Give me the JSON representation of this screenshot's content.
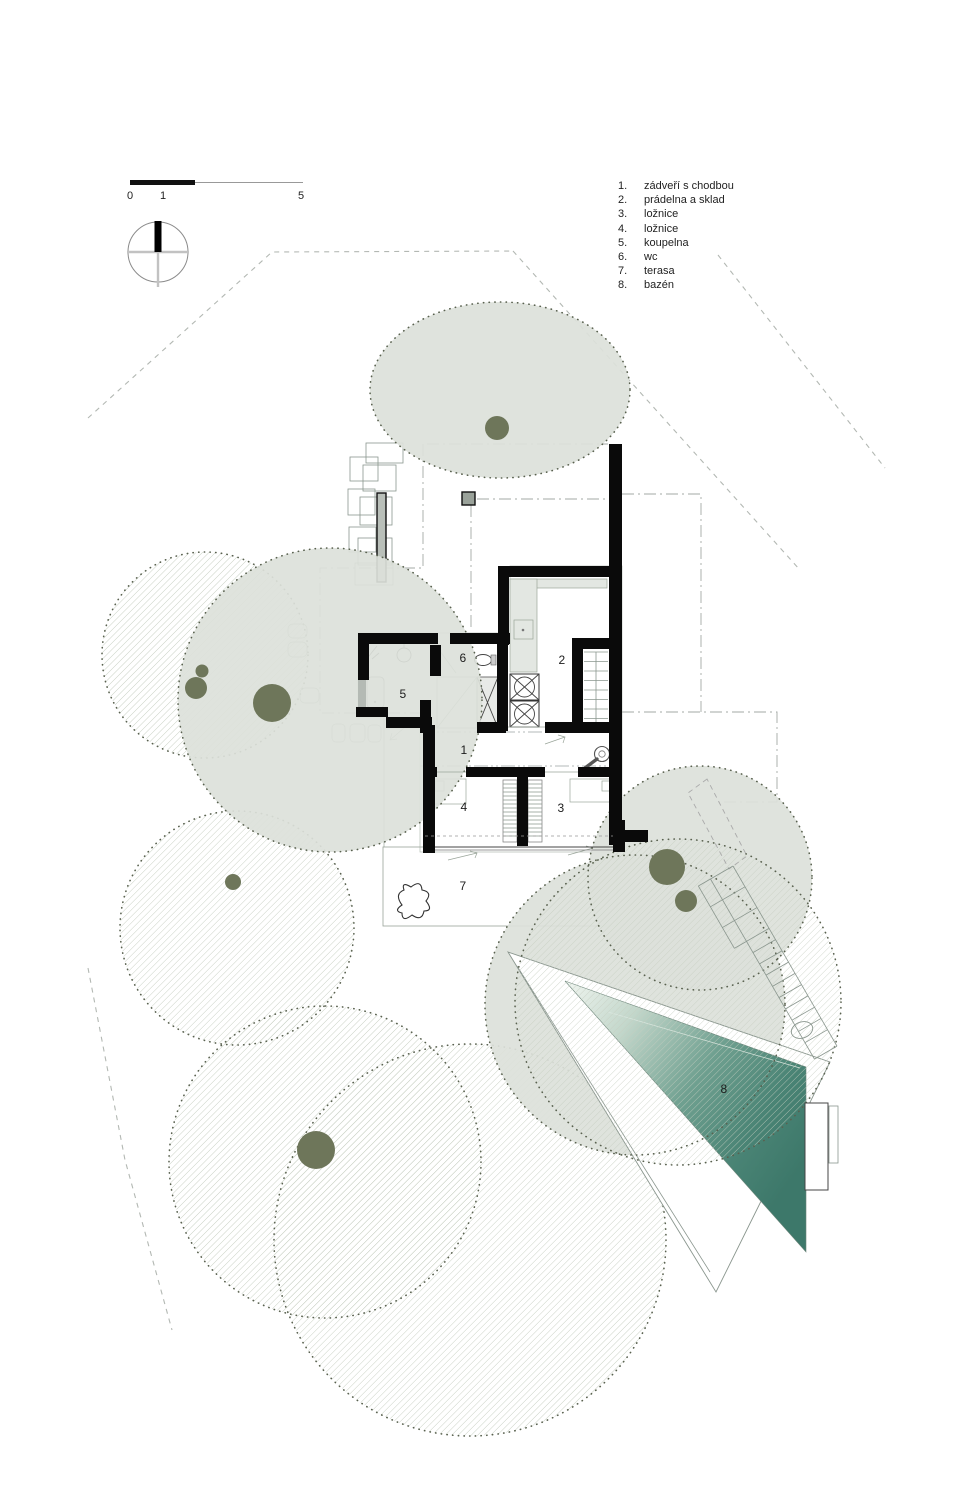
{
  "drawing": {
    "type": "site-floor-plan",
    "language": "cs"
  },
  "legend": {
    "items": [
      {
        "num": "1.",
        "label": "zádveří s chodbou"
      },
      {
        "num": "2.",
        "label": "prádelna a sklad"
      },
      {
        "num": "3.",
        "label": "ložnice"
      },
      {
        "num": "4.",
        "label": "ložnice"
      },
      {
        "num": "5.",
        "label": "koupelna"
      },
      {
        "num": "6.",
        "label": "wc"
      },
      {
        "num": "7.",
        "label": "terasa"
      },
      {
        "num": "8.",
        "label": "bazén"
      }
    ]
  },
  "rooms": [
    {
      "num": "1",
      "x": 464,
      "y": 750
    },
    {
      "num": "2",
      "x": 562,
      "y": 660
    },
    {
      "num": "3",
      "x": 561,
      "y": 808
    },
    {
      "num": "4",
      "x": 464,
      "y": 807
    },
    {
      "num": "5",
      "x": 403,
      "y": 694
    },
    {
      "num": "6",
      "x": 463,
      "y": 658
    },
    {
      "num": "7",
      "x": 463,
      "y": 886
    },
    {
      "num": "8",
      "x": 724,
      "y": 1089
    }
  ],
  "scalebar": {
    "start": "0",
    "mid": "1",
    "end": "5"
  },
  "colors": {
    "canopy_sage": "#dce1da",
    "trunk_olive": "#6e765a",
    "hatch_line": "#c6cec1",
    "dot_border": "#59614f",
    "wall_black": "#0a0a0a",
    "pool_light": "#f0f5f0",
    "pool_mid": "#6fa090",
    "pool_deep": "#3d786a"
  }
}
